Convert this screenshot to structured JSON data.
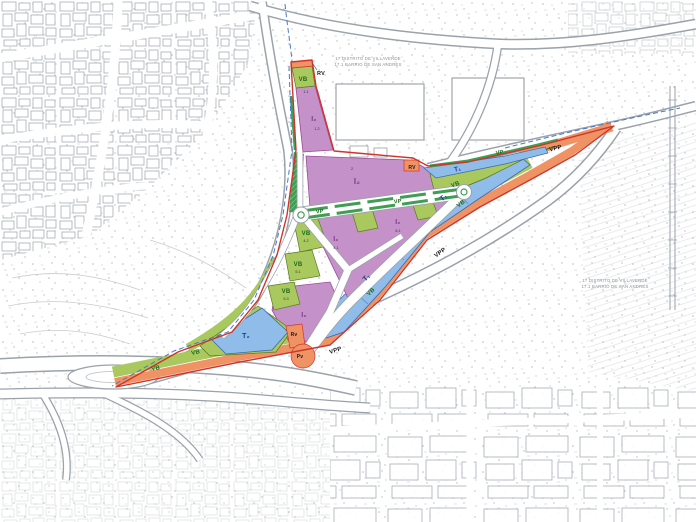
{
  "map": {
    "district_note_top": {
      "line1": "17 DISTRITO DE VILLAVERDE",
      "line2": "17.1 BARRIO DE SAN ANDRES"
    },
    "district_note_right": {
      "line1": "17 DISTRITO DE VILLAVERDE",
      "line2": "17.1 BARRIO DE SAN ANDRES"
    }
  },
  "zones": {
    "rv_top": "RV",
    "vb_top": "VB",
    "i2_wedge": "I₂",
    "i2_main": "I₂",
    "rv_mid": "RV",
    "t1_upper": "T₁",
    "vp_upper": "VP",
    "vb_upper": "VB",
    "vp_blvd_1": "VP",
    "vp_blvd_2": "VP",
    "vb_col_1": "VB",
    "vb_col_2": "VB",
    "vb_col_3": "VB",
    "i2_fan_a": "I₂",
    "i2_fan_b": "I₂",
    "i2_lower": "I₂",
    "t1_band_upper": "T₁",
    "t1_band_lower": "T₁",
    "vb_band_1": "VB",
    "vb_band_2": "VB",
    "t2": "T₂",
    "vb_bottom_1": "VB",
    "vb_bottom_2": "VB",
    "rv_small": "Rv",
    "pv": "Pv",
    "vpp_1": "VPP",
    "vpp_2": "VPP",
    "vpp_3": "VPP"
  },
  "codes": {
    "c11": "1.1",
    "c12": "1.2",
    "c2": "2",
    "c41": "4.1",
    "c42": "4.2",
    "c51": "5.1",
    "c53": "5.3",
    "c61": "6.1"
  },
  "colors": {
    "industrial_purple": "#c492c8",
    "tertiary_blue": "#8fbce8",
    "green_belt": "#a9c95e",
    "park_green": "#3f9e53",
    "road_orange": "#ef9365",
    "boundary_red": "#d0352b",
    "district_boundary_blue": "#4a78c8",
    "basemap_grey": "#9aa2aa"
  }
}
